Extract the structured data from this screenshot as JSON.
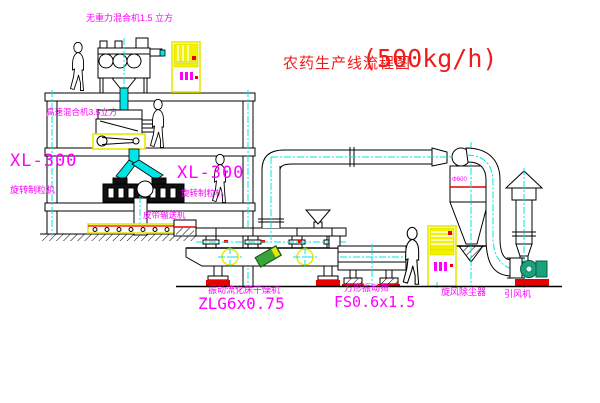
{
  "title": {
    "text_cn": "农药生产线流程图",
    "capacity": "(500kg/h)"
  },
  "labels": {
    "gravity_mixer": "无重力混合机1.5 立方",
    "high_speed_mixer": "高速混合机3.5立方",
    "granulator_model": "XL-300",
    "granulator_name": "旋转制粒机",
    "granulator_model_2": "XL-300",
    "granulator_name_2": "旋转制粒机",
    "belt_conveyor": "皮带输送机",
    "dryer_name": "振动流化床干燥机",
    "dryer_model": "ZLG6x0.75",
    "sieve_name": "方形振动筛",
    "sieve_model": "FS0.6x1.5",
    "cyclone_name": "旋风除尘器",
    "cyclone_dim": "Φ600",
    "fan_name": "引风机"
  },
  "colors": {
    "centerline": "#00e6e6",
    "label_magenta": "#ff00ff",
    "title_red": "#ee1c1c",
    "cad_yellow": "#e8e800",
    "accent_red": "#e60000",
    "fan_teal": "#19a37c"
  }
}
